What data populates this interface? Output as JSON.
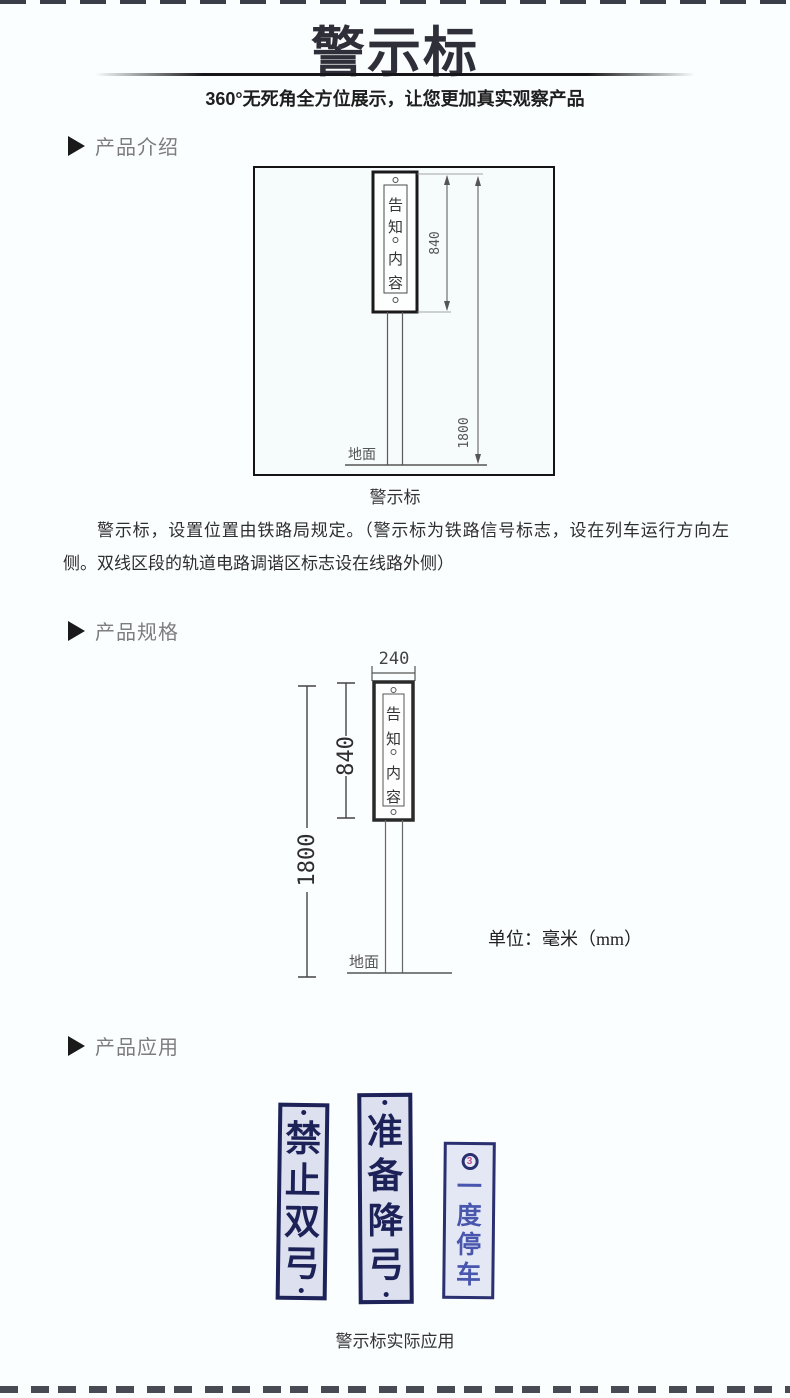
{
  "header": {
    "title": "警示标",
    "subtitle": "360°无死角全方位展示，让您更加真实观察产品"
  },
  "sections": {
    "intro": {
      "label": "产品介绍"
    },
    "spec": {
      "label": "产品规格"
    },
    "app": {
      "label": "产品应用"
    }
  },
  "intro": {
    "diagram": {
      "chars": [
        "告",
        "知",
        "内",
        "容"
      ],
      "dim_sign": "840",
      "dim_total": "1800",
      "ground": "地面"
    },
    "caption": "警示标",
    "paragraph": "警示标，设置位置由铁路局规定。（警示标为铁路信号标志，设在列车运行方向左侧。双线区段的轨道电路调谐区标志设在线路外侧）"
  },
  "spec": {
    "diagram": {
      "dim_width": "240",
      "dim_sign": "840",
      "dim_total": "1800",
      "chars": [
        "告",
        "知",
        "内",
        "容"
      ],
      "ground": "地面",
      "unit": "单位：毫米（mm）"
    }
  },
  "application": {
    "signs": [
      {
        "chars": [
          "禁",
          "止",
          "双",
          "弓"
        ]
      },
      {
        "chars": [
          "准",
          "备",
          "降",
          "弓"
        ]
      },
      {
        "badge": "3",
        "chars": [
          "一",
          "度",
          "停",
          "车"
        ]
      }
    ],
    "caption": "警示标实际应用"
  },
  "colors": {
    "sign_navy": "#1c2257",
    "sign_bg": "#dce0ef",
    "sign3_text": "#4956ad",
    "badge_pink": "#c0558e",
    "page_bg": "#fbfeff"
  }
}
